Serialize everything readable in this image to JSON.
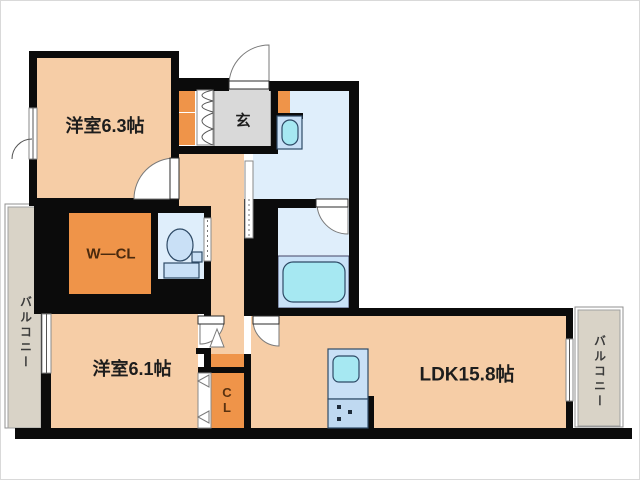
{
  "plan": {
    "type": "apartment-floorplan",
    "rooms": {
      "bedroom1": {
        "label": "洋室6.3帖"
      },
      "entrance": {
        "label": "玄"
      },
      "walk_in_closet": {
        "label": "W—CL"
      },
      "bedroom2": {
        "label": "洋室6.1帖"
      },
      "closet": {
        "char1": "C",
        "char2": "L"
      },
      "ldk": {
        "label": "LDK15.8帖"
      },
      "balcony_left": {
        "label": "バルコニー"
      },
      "balcony_right": {
        "label": "バルコニー"
      }
    },
    "colors": {
      "room_floor": "#f6cda6",
      "closet_orange": "#ef9449",
      "entrance_gray": "#d9d9d9",
      "wet_area_blue": "#dfeefb",
      "bath_zone_blue": "#c9e2f8",
      "fixture_blue": "#c9e0f6",
      "water_cyan": "#a6e8f2",
      "balcony_gray": "#d9d3c7",
      "wall_black": "#0b0b0b"
    }
  }
}
